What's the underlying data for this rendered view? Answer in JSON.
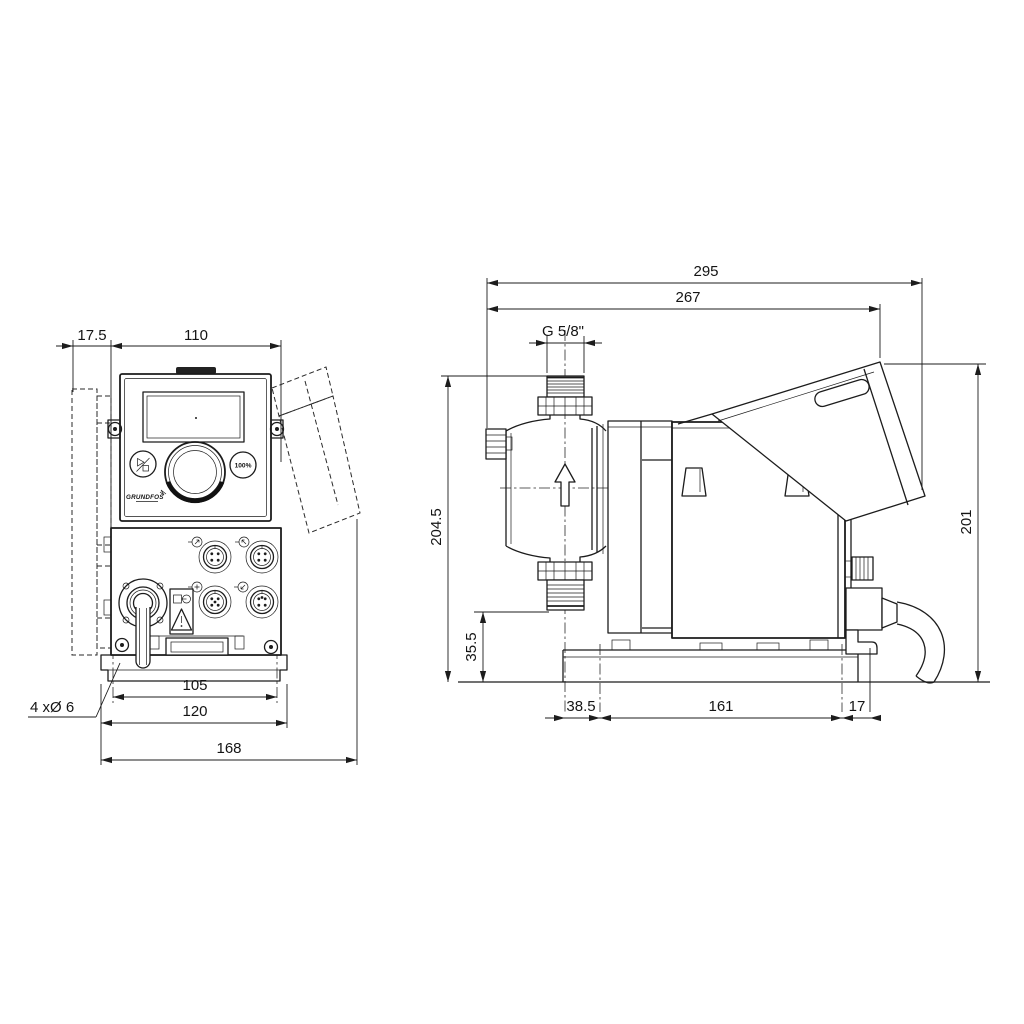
{
  "drawing": {
    "type": "dimensional-drawing-dosing-pump",
    "colors": {
      "ink": "#1c1c1c",
      "background": "#ffffff"
    },
    "controls": {
      "brand": "GRUNDFOS",
      "percent_button": "100%"
    },
    "front": {
      "dims": {
        "offset": "17.5",
        "body_width": "110",
        "hole_spacing": "105",
        "plate_width": "120",
        "overall_width": "168"
      },
      "hole_note": "4 xØ 6"
    },
    "side": {
      "dims": {
        "overall_length": "295",
        "length_to_hood": "267",
        "connection_thread": "G 5/8\"",
        "height_to_connection": "204.5",
        "suction_height": "35.5",
        "overall_height": "201",
        "center_to_hole": "38.5",
        "hole_spacing": "161",
        "hole_to_rear": "17"
      }
    },
    "icons": [
      "start-stop-icon",
      "hundred-percent-icon",
      "click-wheel-dial-icon",
      "warning-triangle-icon",
      "power-plug-icon",
      "flow-direction-arrow-icon",
      "m12-connector-icon",
      "cable-gland-icon",
      "vent-valve-icon"
    ]
  }
}
